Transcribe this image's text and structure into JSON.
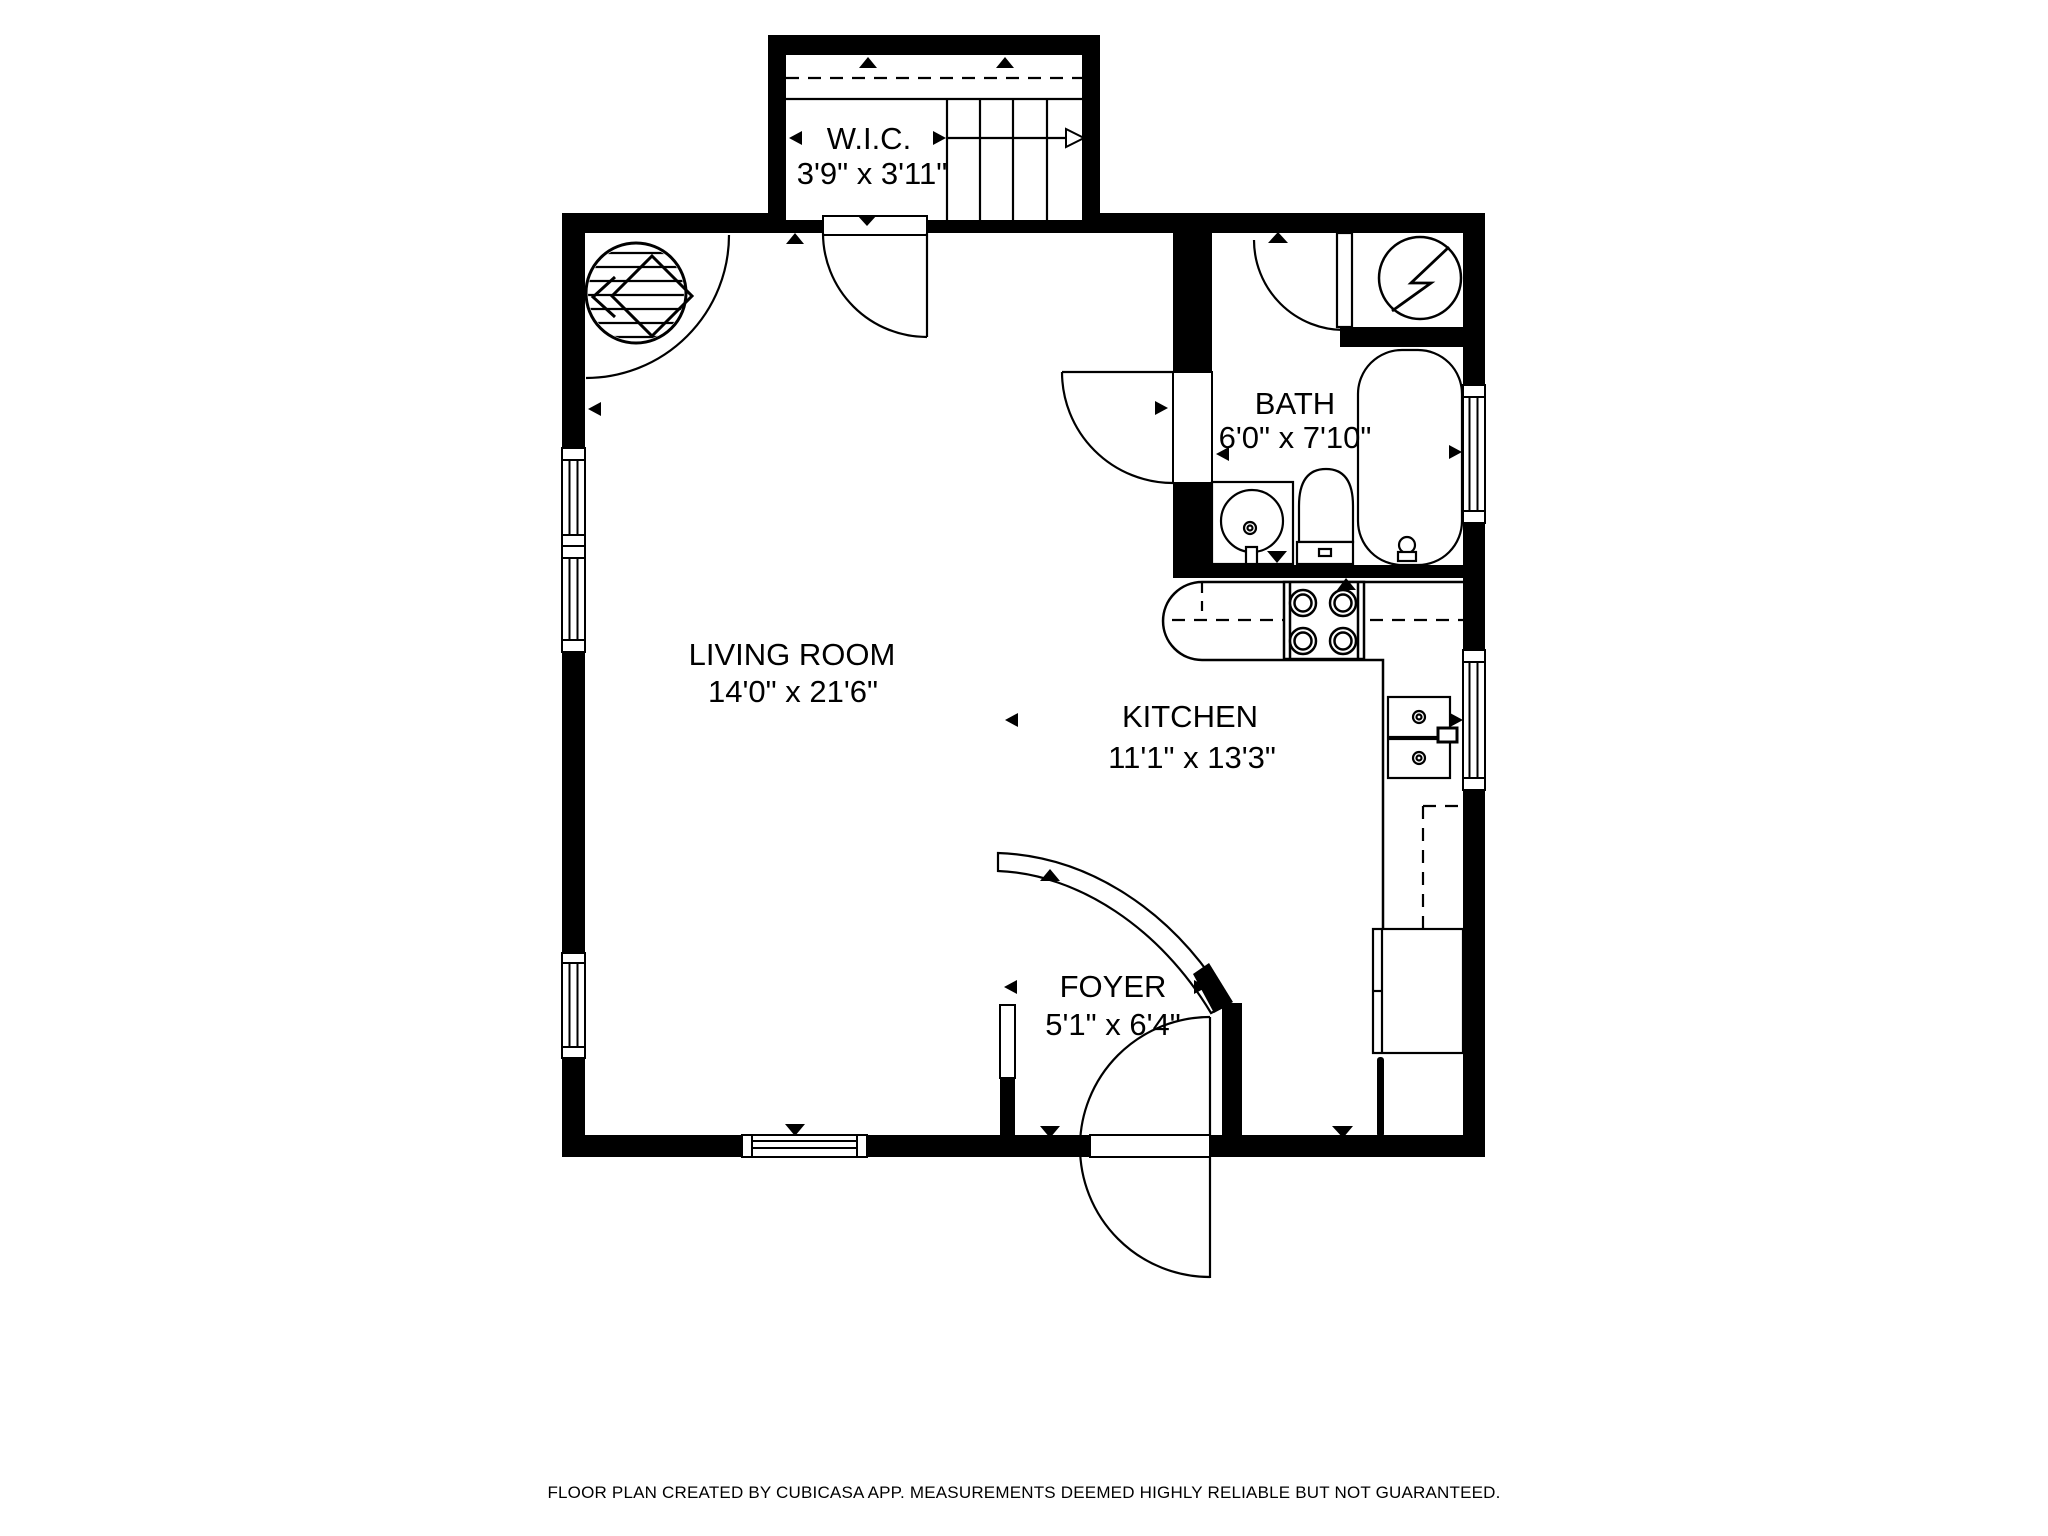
{
  "floorplan": {
    "title": "Floor plan",
    "rooms": {
      "wic": {
        "name": "W.I.C.",
        "dims": "3'9\" x 3'11\""
      },
      "bath": {
        "name": "BATH",
        "dims": "6'0\" x 7'10\""
      },
      "living": {
        "name": "LIVING ROOM",
        "dims": "14'0\" x 21'6\""
      },
      "kitchen": {
        "name": "KITCHEN",
        "dims": "11'1\" x 13'3\""
      },
      "foyer": {
        "name": "FOYER",
        "dims": "5'1\" x 6'4\""
      }
    },
    "fixtures": [
      "staircase",
      "closet-shelf",
      "fireplace",
      "water-heater",
      "bathtub",
      "toilet",
      "bathroom-sink",
      "stove",
      "kitchen-counter",
      "kitchen-sink",
      "refrigerator",
      "entry-door",
      "windows"
    ],
    "colors": {
      "wall": "#000000",
      "background": "#ffffff",
      "line": "#000000"
    },
    "footer": {
      "disclaimer": "FLOOR PLAN CREATED BY CUBICASA APP. MEASUREMENTS DEEMED HIGHLY RELIABLE BUT NOT GUARANTEED."
    }
  }
}
